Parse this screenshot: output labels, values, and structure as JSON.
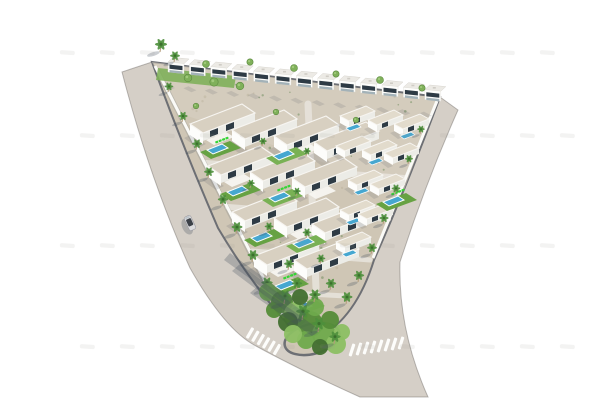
{
  "meta": {
    "title": "Aerial 3D render of a triangular white-villa development with pools, palm trees, perimeter roads, crosswalks and one parked car",
    "background": "#ffffff"
  },
  "palette": {
    "road": "#d5cfc7",
    "roadEdge": "rgba(108,104,99,0.45)",
    "sand": "#cfc6b5",
    "sandLight": "#d9d1c3",
    "curb": "#6d6f74",
    "wallWhite": "#fafaf7",
    "street": "#e7e3db",
    "roof": "#d8d0c1",
    "roofSmall": "#e2dbcc",
    "parapet": "#f7f5f1",
    "wallLight": "#fdfdfb",
    "wallShade": "#ecece7",
    "window": "#2e3b45",
    "groundGlass": "#a3b2b8",
    "thRoof": "#eceae5",
    "lawn": "#67a243",
    "lawn2": "#79b154",
    "deck": "#35d435",
    "pool": "#46a7d0",
    "trunk": "#b29b79",
    "palm": "#4e8f3c",
    "palmDark": "#3c6e2e",
    "bush": "#7fb05a",
    "bushRim": "#5d8a40",
    "shadow": "rgba(70,78,92,0.28)",
    "shadowSoft": "rgba(80,88,100,0.18)",
    "carBody": "#dcdcde",
    "carTop": "#3c4148",
    "stripe": "#fdfdfb",
    "watermark": "#9b968f",
    "vegPalette": [
      "#6faa4c",
      "#548c38",
      "#8cbf63",
      "#426f30"
    ]
  },
  "road": {
    "outline": "M122,72 L152,62 Q180,140 218,228 Q250,282 286,322 Q296,341 318,338 Q356,318 374,260 Q406,188 440,97 L458,110 Q426,182 400,262 Q398,330 428,397 L360,397 Q300,370 256,346 Q225,330 190,268 Q150,180 122,72 Z"
  },
  "plot": {
    "outline": "M152,62 L440,97 Q406,188 374,260 Q356,318 318,338 Q296,341 286,322 Q250,282 218,228 Q180,140 152,62 Z",
    "lightBand": "152,62 438,98 404,190 176,112"
  },
  "walls": [
    {
      "x1": 155,
      "y1": 66,
      "x2": 284,
      "y2": 318
    },
    {
      "x1": 437,
      "y1": 101,
      "x2": 373,
      "y2": 258
    }
  ],
  "wallShadow": {
    "x1": 157,
    "y1": 70,
    "x2": 284,
    "y2": 320
  },
  "innerStreets": [
    [
      206,
      163,
      404,
      178,
      6
    ],
    [
      228,
      207,
      388,
      219,
      6
    ],
    [
      252,
      251,
      370,
      260,
      5
    ],
    [
      272,
      292,
      346,
      296,
      5
    ],
    [
      308,
      104,
      316,
      288,
      7
    ]
  ],
  "townhouses": {
    "x": 168,
    "y": 72,
    "dx": 21.4,
    "dy": 2.3,
    "count": 13
  },
  "hedge": {
    "pts": "158,68 236,76 234,88 156,80"
  },
  "villas": [
    [
      190,
      124,
      1
    ],
    [
      232,
      130,
      0
    ],
    [
      274,
      136,
      1
    ],
    [
      314,
      142,
      0
    ],
    [
      208,
      166,
      1
    ],
    [
      250,
      172,
      0
    ],
    [
      292,
      178,
      1
    ],
    [
      232,
      212,
      0
    ],
    [
      274,
      218,
      1
    ],
    [
      312,
      224,
      0
    ],
    [
      254,
      256,
      1
    ],
    [
      294,
      260,
      0
    ]
  ],
  "smallHouses": [
    [
      340,
      116,
      1
    ],
    [
      368,
      120,
      0
    ],
    [
      394,
      124,
      1
    ],
    [
      336,
      146,
      0
    ],
    [
      362,
      150,
      1
    ],
    [
      384,
      153,
      0
    ],
    [
      348,
      180,
      1
    ],
    [
      370,
      184,
      0
    ],
    [
      340,
      210,
      1
    ],
    [
      358,
      214,
      0
    ],
    [
      336,
      242,
      1
    ]
  ],
  "poolUnits": [
    [
      200,
      152,
      1
    ],
    [
      266,
      158,
      0
    ],
    [
      220,
      194,
      0
    ],
    [
      262,
      200,
      1
    ],
    [
      244,
      240,
      0
    ],
    [
      286,
      246,
      0
    ],
    [
      268,
      288,
      1
    ],
    [
      284,
      310,
      0
    ],
    [
      376,
      204,
      1
    ]
  ],
  "palms": [
    [
      168,
      92,
      0.8
    ],
    [
      182,
      122,
      0.85
    ],
    [
      196,
      150,
      0.9
    ],
    [
      208,
      178,
      0.9
    ],
    [
      222,
      206,
      0.95
    ],
    [
      236,
      234,
      1
    ],
    [
      252,
      262,
      1
    ],
    [
      266,
      290,
      1.05
    ],
    [
      420,
      134,
      0.7
    ],
    [
      408,
      164,
      0.75
    ],
    [
      395,
      194,
      0.8
    ],
    [
      383,
      224,
      0.85
    ],
    [
      371,
      254,
      0.9
    ],
    [
      358,
      282,
      0.95
    ],
    [
      346,
      304,
      1
    ],
    [
      262,
      146,
      0.7
    ],
    [
      306,
      156,
      0.7
    ],
    [
      250,
      188,
      0.7
    ],
    [
      296,
      196,
      0.7
    ],
    [
      268,
      232,
      0.8
    ],
    [
      306,
      238,
      0.8
    ],
    [
      288,
      270,
      0.9
    ],
    [
      320,
      264,
      0.8
    ],
    [
      160,
      52,
      1.1
    ],
    [
      174,
      62,
      0.9
    ],
    [
      330,
      290,
      0.95
    ]
  ],
  "bushes": [
    [
      206,
      64,
      1
    ],
    [
      250,
      62,
      0.9
    ],
    [
      294,
      68,
      1
    ],
    [
      336,
      74,
      0.9
    ],
    [
      380,
      80,
      1
    ],
    [
      422,
      88,
      0.9
    ],
    [
      196,
      106,
      0.8
    ],
    [
      276,
      112,
      0.8
    ],
    [
      356,
      120,
      0.8
    ],
    [
      188,
      78,
      1.1
    ],
    [
      214,
      82,
      1.2
    ],
    [
      240,
      86,
      1.1
    ]
  ],
  "cornerVeg": {
    "ring": {
      "cx": 312,
      "cy": 339,
      "rx": 28,
      "ry": 15,
      "rot": -14
    },
    "blobs": [
      [
        268,
        292,
        9,
        0
      ],
      [
        282,
        302,
        11,
        1
      ],
      [
        296,
        314,
        12,
        2
      ],
      [
        310,
        324,
        13,
        1
      ],
      [
        324,
        334,
        12,
        0
      ],
      [
        336,
        344,
        10,
        2
      ],
      [
        300,
        297,
        8,
        3
      ],
      [
        315,
        307,
        9,
        0
      ],
      [
        330,
        320,
        9,
        1
      ],
      [
        342,
        332,
        8,
        2
      ],
      [
        288,
        322,
        10,
        3
      ],
      [
        274,
        310,
        8,
        1
      ],
      [
        306,
        340,
        9,
        0
      ],
      [
        320,
        347,
        8,
        3
      ],
      [
        293,
        334,
        9,
        2
      ]
    ],
    "palms": [
      [
        284,
        304,
        1.15
      ],
      [
        302,
        320,
        1.25
      ],
      [
        318,
        332,
        1.2
      ],
      [
        334,
        344,
        1.05
      ],
      [
        296,
        290,
        0.95
      ],
      [
        314,
        302,
        1.05
      ]
    ]
  },
  "shadowStreaks": [
    [
      300,
      322,
      306,
      314,
      240,
      264,
      232,
      271
    ],
    [
      312,
      336,
      320,
      330,
      258,
      286,
      250,
      293
    ],
    [
      288,
      306,
      293,
      299,
      230,
      253,
      224,
      260
    ]
  ],
  "car": {
    "x": 190,
    "y": 223,
    "angle": -25
  },
  "crosswalks": [
    {
      "x": 250,
      "y": 333,
      "dx": 5.4,
      "dy": 3.3,
      "n": 6,
      "rot": 30,
      "w": 3.2,
      "h": 12
    },
    {
      "x": 352,
      "y": 350,
      "dx": 7.0,
      "dy": -1.0,
      "n": 8,
      "rot": 18,
      "w": 3.2,
      "h": 13
    }
  ],
  "watermark": {
    "rows": [
      50,
      133,
      243,
      344
    ],
    "x0": 60,
    "dx": 40,
    "n": 13,
    "w": 15,
    "h": 4.2,
    "rot": 4,
    "opacity": 0.12
  },
  "speckles": {
    "count": 70,
    "seed": 7,
    "tri": [
      160,
      70,
      430,
      100,
      310,
      325
    ]
  }
}
